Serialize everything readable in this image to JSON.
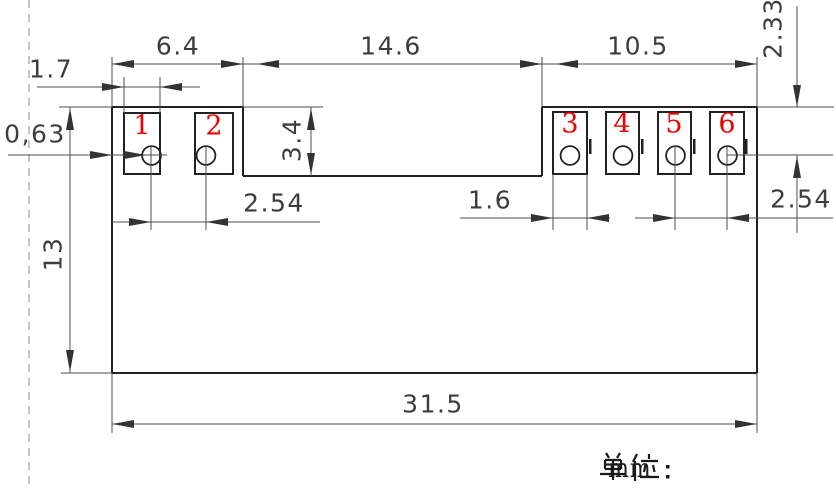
{
  "unit_note": {
    "label": "单位：",
    "value": "mm"
  },
  "pads": [
    {
      "number": "1"
    },
    {
      "number": "2"
    },
    {
      "number": "3"
    },
    {
      "number": "4"
    },
    {
      "number": "5"
    },
    {
      "number": "6"
    }
  ],
  "dimensions": {
    "left_section_width": "6.4",
    "middle_section_width": "14.6",
    "right_section_width": "10.5",
    "left_pad_width": "1.7",
    "edge_to_pad_offset": "0,63",
    "notch_depth": "3.4",
    "left_hole_pitch": "2.54",
    "right_pad_width": "1.6",
    "right_hole_pitch": "2.54",
    "body_height": "13",
    "top_edge_to_hole": "2.33",
    "overall_width": "31.5"
  },
  "colors": {
    "outline": "#222222",
    "dimension_line": "#4d4d4d",
    "label_text": "#3d3d3d",
    "pad_number_red": "#f10000",
    "dashed_guide": "#b0b0b0",
    "background": "#ffffff"
  }
}
